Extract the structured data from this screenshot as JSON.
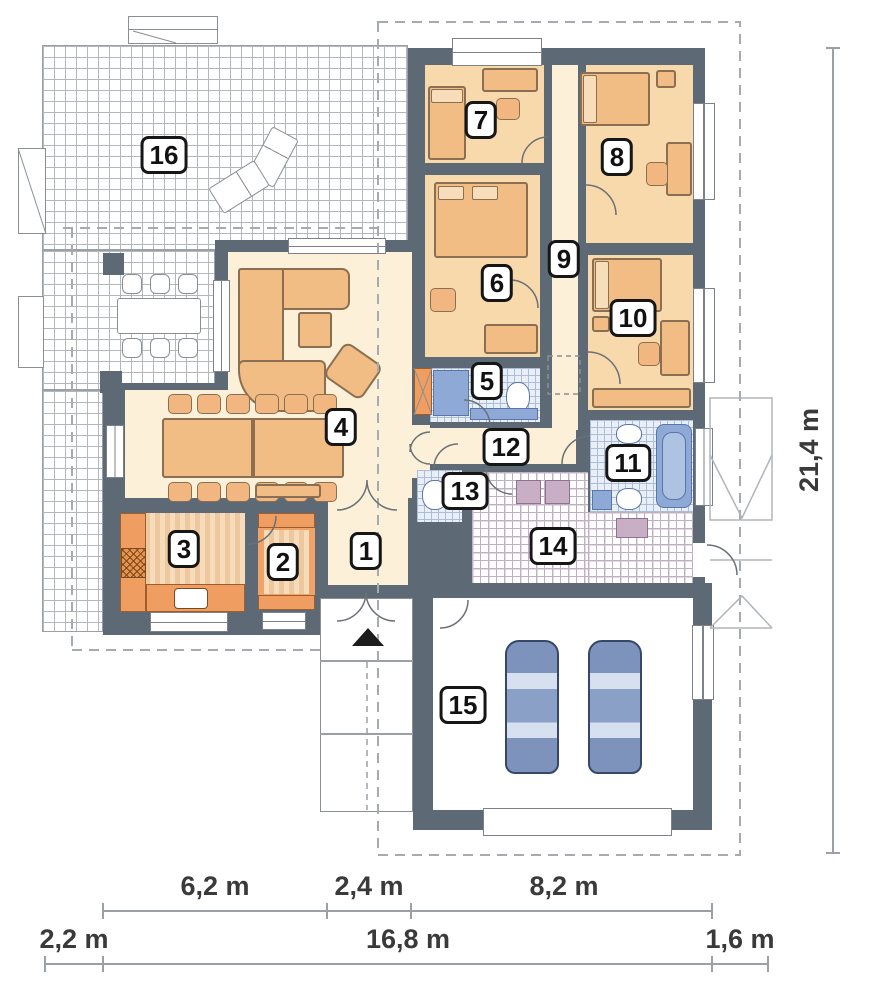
{
  "plan": {
    "title": "Single-storey house floor plan",
    "rooms": [
      {
        "label": "1",
        "type": "entrance-hall"
      },
      {
        "label": "2",
        "type": "pantry"
      },
      {
        "label": "3",
        "type": "kitchen"
      },
      {
        "label": "4",
        "type": "living-dining-room"
      },
      {
        "label": "5",
        "type": "bathroom"
      },
      {
        "label": "6",
        "type": "bedroom"
      },
      {
        "label": "7",
        "type": "bedroom"
      },
      {
        "label": "8",
        "type": "bedroom"
      },
      {
        "label": "9",
        "type": "hallway"
      },
      {
        "label": "10",
        "type": "bedroom"
      },
      {
        "label": "11",
        "type": "bathroom"
      },
      {
        "label": "12",
        "type": "corridor"
      },
      {
        "label": "13",
        "type": "wc"
      },
      {
        "label": "14",
        "type": "utility-room"
      },
      {
        "label": "15",
        "type": "garage"
      },
      {
        "label": "16",
        "type": "terrace"
      }
    ],
    "dimensions": {
      "row_inner": [
        "6,2 m",
        "2,4 m",
        "8,2 m"
      ],
      "row_outer": [
        "2,2 m",
        "16,8 m",
        "1,6 m"
      ],
      "right": "21,4 m"
    },
    "icons": {
      "entrance_marker": "entrance-triangle"
    },
    "colors": {
      "wall": "#5d6974",
      "living_floor": "#fcf0d8",
      "bedroom_floor": "#f8d9ab",
      "furniture": "#f2bc85",
      "kitchen_counter": "#ef9d60",
      "bath_fixture": "#8fa9d6",
      "tile_floor": "#e9eef7",
      "car_body": "#7e93bb",
      "dimension_text": "#3a3a3a"
    }
  }
}
